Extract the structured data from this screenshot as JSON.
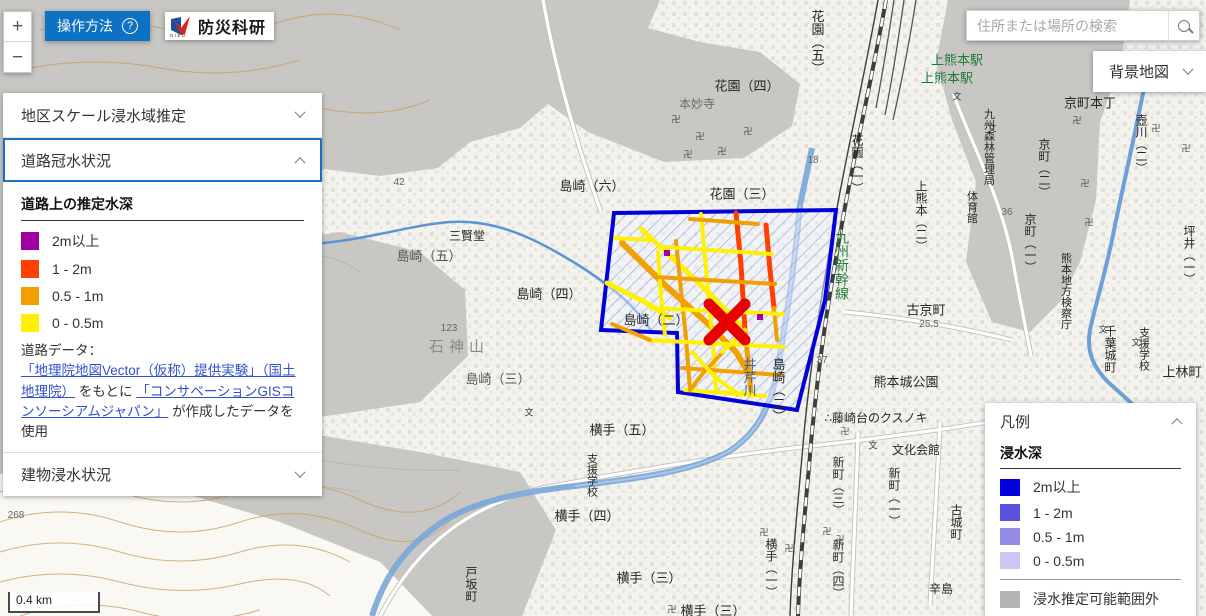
{
  "header": {
    "help_button": "操作方法",
    "logo_text": "防災科研",
    "logo_sub": "NIED",
    "search_placeholder": "住所または場所の検索",
    "basemap_button": "背景地図"
  },
  "zoom_controls": {
    "zoom_in": "+",
    "zoom_out": "−"
  },
  "left_panel": {
    "sections": [
      {
        "label": "地区スケール浸水域推定",
        "state": "collapsed"
      },
      {
        "label": "道路冠水状況",
        "state": "expanded"
      },
      {
        "label": "建物浸水状況",
        "state": "collapsed"
      }
    ],
    "road_depth": {
      "title": "道路上の推定水深",
      "items": [
        {
          "label": "2m以上",
          "color": "#A000A0"
        },
        {
          "label": "1 - 2m",
          "color": "#FF4000"
        },
        {
          "label": "0.5 - 1m",
          "color": "#F2A000"
        },
        {
          "label": "0 - 0.5m",
          "color": "#FFF100"
        }
      ]
    },
    "source_note": {
      "prefix": "道路データ：",
      "link1": "「地理院地図Vector（仮称）提供実験」（国土地理院）",
      "mid": "をもとに",
      "link2": "「コンサベーションGISコンソーシアムジャパン」",
      "suffix": "が作成したデータを使用"
    }
  },
  "legend_panel": {
    "title": "凡例",
    "subtitle": "浸水深",
    "items": [
      {
        "label": "2m以上",
        "color": "#0000DC"
      },
      {
        "label": "1 - 2m",
        "color": "#5A50DC"
      },
      {
        "label": "0.5 - 1m",
        "color": "#928AE4"
      },
      {
        "label": "0 - 0.5m",
        "color": "#CCC8F4"
      }
    ],
    "out_of_range": {
      "label": "浸水推定可能範囲外",
      "color": "#B4B4B4"
    }
  },
  "scale_bar": {
    "label": "0.4 km"
  },
  "map": {
    "colors": {
      "accent": "#0d72c4",
      "accent2": "#1771c6",
      "polygon": "#0000D8",
      "x_marker": "#E60000"
    },
    "x_marker": {
      "x": 727,
      "y": 322
    },
    "labels": [
      {
        "t": "島崎（六）",
        "x": 592,
        "y": 186
      },
      {
        "t": "花園（四）",
        "x": 747,
        "y": 86
      },
      {
        "t": "本妙寺",
        "x": 697,
        "y": 104,
        "c": "#6b6b6b",
        "s": 12
      },
      {
        "t": "花園（三）",
        "x": 742,
        "y": 194
      },
      {
        "t": "三賢堂",
        "x": 467,
        "y": 236,
        "s": 12
      },
      {
        "t": "島崎（五）",
        "x": 429,
        "y": 256,
        "c": "#555555"
      },
      {
        "t": "島崎（四）",
        "x": 549,
        "y": 294
      },
      {
        "t": "石神山",
        "x": 459,
        "y": 347,
        "c": "#8a8a8a",
        "s": 15,
        "ls": 5
      },
      {
        "t": "島崎（三）",
        "x": 498,
        "y": 379,
        "c": "#555555"
      },
      {
        "t": "島崎（二）",
        "x": 656,
        "y": 320
      },
      {
        "t": "谷尾崎町",
        "x": 263,
        "y": 467,
        "c": "#777777",
        "ls": 4
      },
      {
        "t": "横手（五）",
        "x": 622,
        "y": 430
      },
      {
        "t": "横手（四）",
        "x": 587,
        "y": 516
      },
      {
        "t": "横手（三）",
        "x": 649,
        "y": 578
      },
      {
        "t": "横手（三）",
        "x": 713,
        "y": 611
      },
      {
        "t": "古京町",
        "x": 926,
        "y": 310
      },
      {
        "t": "京町本丁",
        "x": 1090,
        "y": 103
      },
      {
        "t": "熊本城公園",
        "x": 906,
        "y": 382
      },
      {
        "t": "∴藤崎台のクスノキ",
        "x": 876,
        "y": 418,
        "s": 12
      },
      {
        "t": "文化会館",
        "x": 916,
        "y": 450,
        "s": 12
      },
      {
        "t": "上林町",
        "x": 1182,
        "y": 372
      },
      {
        "t": "上熊本駅",
        "x": 957,
        "y": 60,
        "c": "#1f7a33"
      },
      {
        "t": "上熊本駅",
        "x": 947,
        "y": 78,
        "c": "#1f7a33"
      },
      {
        "t": "辛島",
        "x": 941,
        "y": 589,
        "s": 12
      },
      {
        "t": "市街",
        "x": 1073,
        "y": 610,
        "c": "#666666",
        "ls": 5
      },
      {
        "t": "268",
        "x": 16,
        "y": 516,
        "c": "#666666",
        "s": 10
      },
      {
        "t": "123",
        "x": 449,
        "y": 329,
        "c": "#666666",
        "s": 10
      },
      {
        "t": "46",
        "x": 300,
        "y": 488,
        "c": "#666666",
        "s": 10
      },
      {
        "t": "42",
        "x": 399,
        "y": 183,
        "c": "#666666",
        "s": 10
      },
      {
        "t": "36",
        "x": 1007,
        "y": 213,
        "c": "#666666",
        "s": 10
      },
      {
        "t": "25.5",
        "x": 929,
        "y": 325,
        "c": "#666666",
        "s": 10
      },
      {
        "t": "18",
        "x": 813,
        "y": 161,
        "c": "#666666",
        "s": 10
      },
      {
        "t": "37",
        "x": 822,
        "y": 361,
        "c": "#666666",
        "s": 10
      },
      {
        "t": "花園（五）",
        "x": 817,
        "y": 42,
        "v": 1
      },
      {
        "t": "花園（一）",
        "x": 857,
        "y": 164,
        "v": 1,
        "s": 12
      },
      {
        "t": "九州新幹線",
        "x": 842,
        "y": 265,
        "v": 1,
        "c": "#1b7d3c",
        "s": 14
      },
      {
        "t": "井芹川",
        "x": 749,
        "y": 377,
        "v": 1,
        "c": "#3a5fae"
      },
      {
        "t": "島崎（二）",
        "x": 778,
        "y": 390,
        "v": 1
      },
      {
        "t": "九州森林管理局",
        "x": 988,
        "y": 147,
        "v": 1,
        "s": 11
      },
      {
        "t": "上熊本（二）",
        "x": 921,
        "y": 216,
        "v": 1,
        "s": 12
      },
      {
        "t": "体育館",
        "x": 971,
        "y": 207,
        "v": 1,
        "s": 11
      },
      {
        "t": "京町（二）",
        "x": 1044,
        "y": 168,
        "v": 1,
        "s": 12
      },
      {
        "t": "京町（一）",
        "x": 1030,
        "y": 243,
        "v": 1,
        "s": 12
      },
      {
        "t": "壺川（二）",
        "x": 1141,
        "y": 144,
        "v": 1,
        "s": 12
      },
      {
        "t": "熊本地方検察庁",
        "x": 1065,
        "y": 291,
        "v": 1,
        "s": 11
      },
      {
        "t": "坪井（一）",
        "x": 1189,
        "y": 255,
        "v": 1,
        "s": 12
      },
      {
        "t": "千葉城町",
        "x": 1110,
        "y": 349,
        "v": 1,
        "s": 12
      },
      {
        "t": "支援学校",
        "x": 1143,
        "y": 349,
        "v": 1,
        "s": 11
      },
      {
        "t": "支援学校",
        "x": 591,
        "y": 475,
        "v": 1,
        "s": 11
      },
      {
        "t": "新町（三）",
        "x": 838,
        "y": 486,
        "v": 1,
        "s": 12
      },
      {
        "t": "新町（一）",
        "x": 894,
        "y": 497,
        "v": 1,
        "s": 12
      },
      {
        "t": "新町（四）",
        "x": 838,
        "y": 569,
        "v": 1,
        "s": 12
      },
      {
        "t": "古城町",
        "x": 956,
        "y": 522,
        "v": 1,
        "s": 12
      },
      {
        "t": "横手（一）",
        "x": 771,
        "y": 568,
        "v": 1,
        "s": 12
      },
      {
        "t": "戸坂町",
        "x": 471,
        "y": 584,
        "v": 1,
        "s": 12
      },
      {
        "t": "卍",
        "x": 676,
        "y": 120,
        "c": "#444444",
        "s": 9
      },
      {
        "t": "卍",
        "x": 700,
        "y": 137,
        "c": "#444444",
        "s": 9
      },
      {
        "t": "卍",
        "x": 722,
        "y": 152,
        "c": "#444444",
        "s": 9
      },
      {
        "t": "卍",
        "x": 748,
        "y": 132,
        "c": "#444444",
        "s": 9
      },
      {
        "t": "卍",
        "x": 688,
        "y": 155,
        "c": "#444444",
        "s": 9
      },
      {
        "t": "卍",
        "x": 1077,
        "y": 121,
        "c": "#444444",
        "s": 9
      },
      {
        "t": "卍",
        "x": 1156,
        "y": 129,
        "c": "#444444",
        "s": 9
      },
      {
        "t": "卍",
        "x": 1186,
        "y": 149,
        "c": "#444444",
        "s": 9
      },
      {
        "t": "卍",
        "x": 1085,
        "y": 184,
        "c": "#444444",
        "s": 9
      },
      {
        "t": "卍",
        "x": 1089,
        "y": 223,
        "c": "#444444",
        "s": 9
      },
      {
        "t": "卍",
        "x": 845,
        "y": 432,
        "c": "#444444",
        "s": 9
      },
      {
        "t": "卍",
        "x": 827,
        "y": 532,
        "c": "#444444",
        "s": 9
      },
      {
        "t": "卍",
        "x": 840,
        "y": 540,
        "c": "#444444",
        "s": 9
      },
      {
        "t": "卍",
        "x": 672,
        "y": 610,
        "c": "#444444",
        "s": 9
      },
      {
        "t": "卍",
        "x": 764,
        "y": 533,
        "c": "#444444",
        "s": 9
      },
      {
        "t": "卍",
        "x": 789,
        "y": 549,
        "c": "#444444",
        "s": 9
      },
      {
        "t": "文",
        "x": 957,
        "y": 97,
        "c": "#333333",
        "s": 9
      },
      {
        "t": "文",
        "x": 992,
        "y": 129,
        "c": "#333333",
        "s": 9
      },
      {
        "t": "文",
        "x": 1103,
        "y": 330,
        "c": "#333333",
        "s": 9
      },
      {
        "t": "文",
        "x": 1136,
        "y": 343,
        "c": "#333333",
        "s": 9
      },
      {
        "t": "文",
        "x": 873,
        "y": 446,
        "c": "#333333",
        "s": 9
      },
      {
        "t": "文",
        "x": 529,
        "y": 413,
        "c": "#333333",
        "s": 9
      }
    ]
  }
}
